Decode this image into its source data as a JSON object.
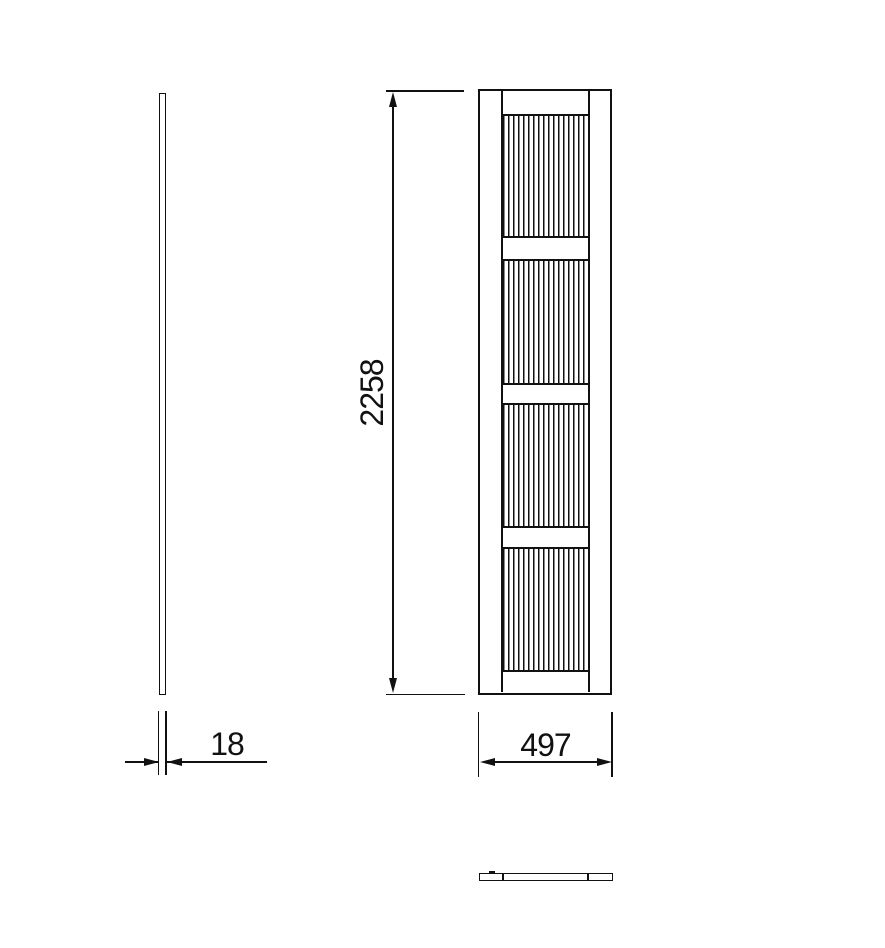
{
  "drawing": {
    "type": "fluted panel technical drawing, three orthographic views",
    "dimensions": {
      "height": "2258",
      "width": "497",
      "thickness": "18"
    },
    "colors": {
      "line": "#111111",
      "background": "#ffffff"
    },
    "front_view": {
      "flute_period_px": 5,
      "sections": [
        {
          "type": "rail",
          "h": 24.5
        },
        {
          "type": "flutes",
          "h": 120.5
        },
        {
          "type": "rail",
          "h": 24.5
        },
        {
          "type": "flutes",
          "h": 122
        },
        {
          "type": "rail",
          "h": 22
        },
        {
          "type": "flutes",
          "h": 121
        },
        {
          "type": "rail",
          "h": 23
        },
        {
          "type": "flutes",
          "h": 121.5
        },
        {
          "type": "rail",
          "h": 22
        }
      ]
    }
  }
}
